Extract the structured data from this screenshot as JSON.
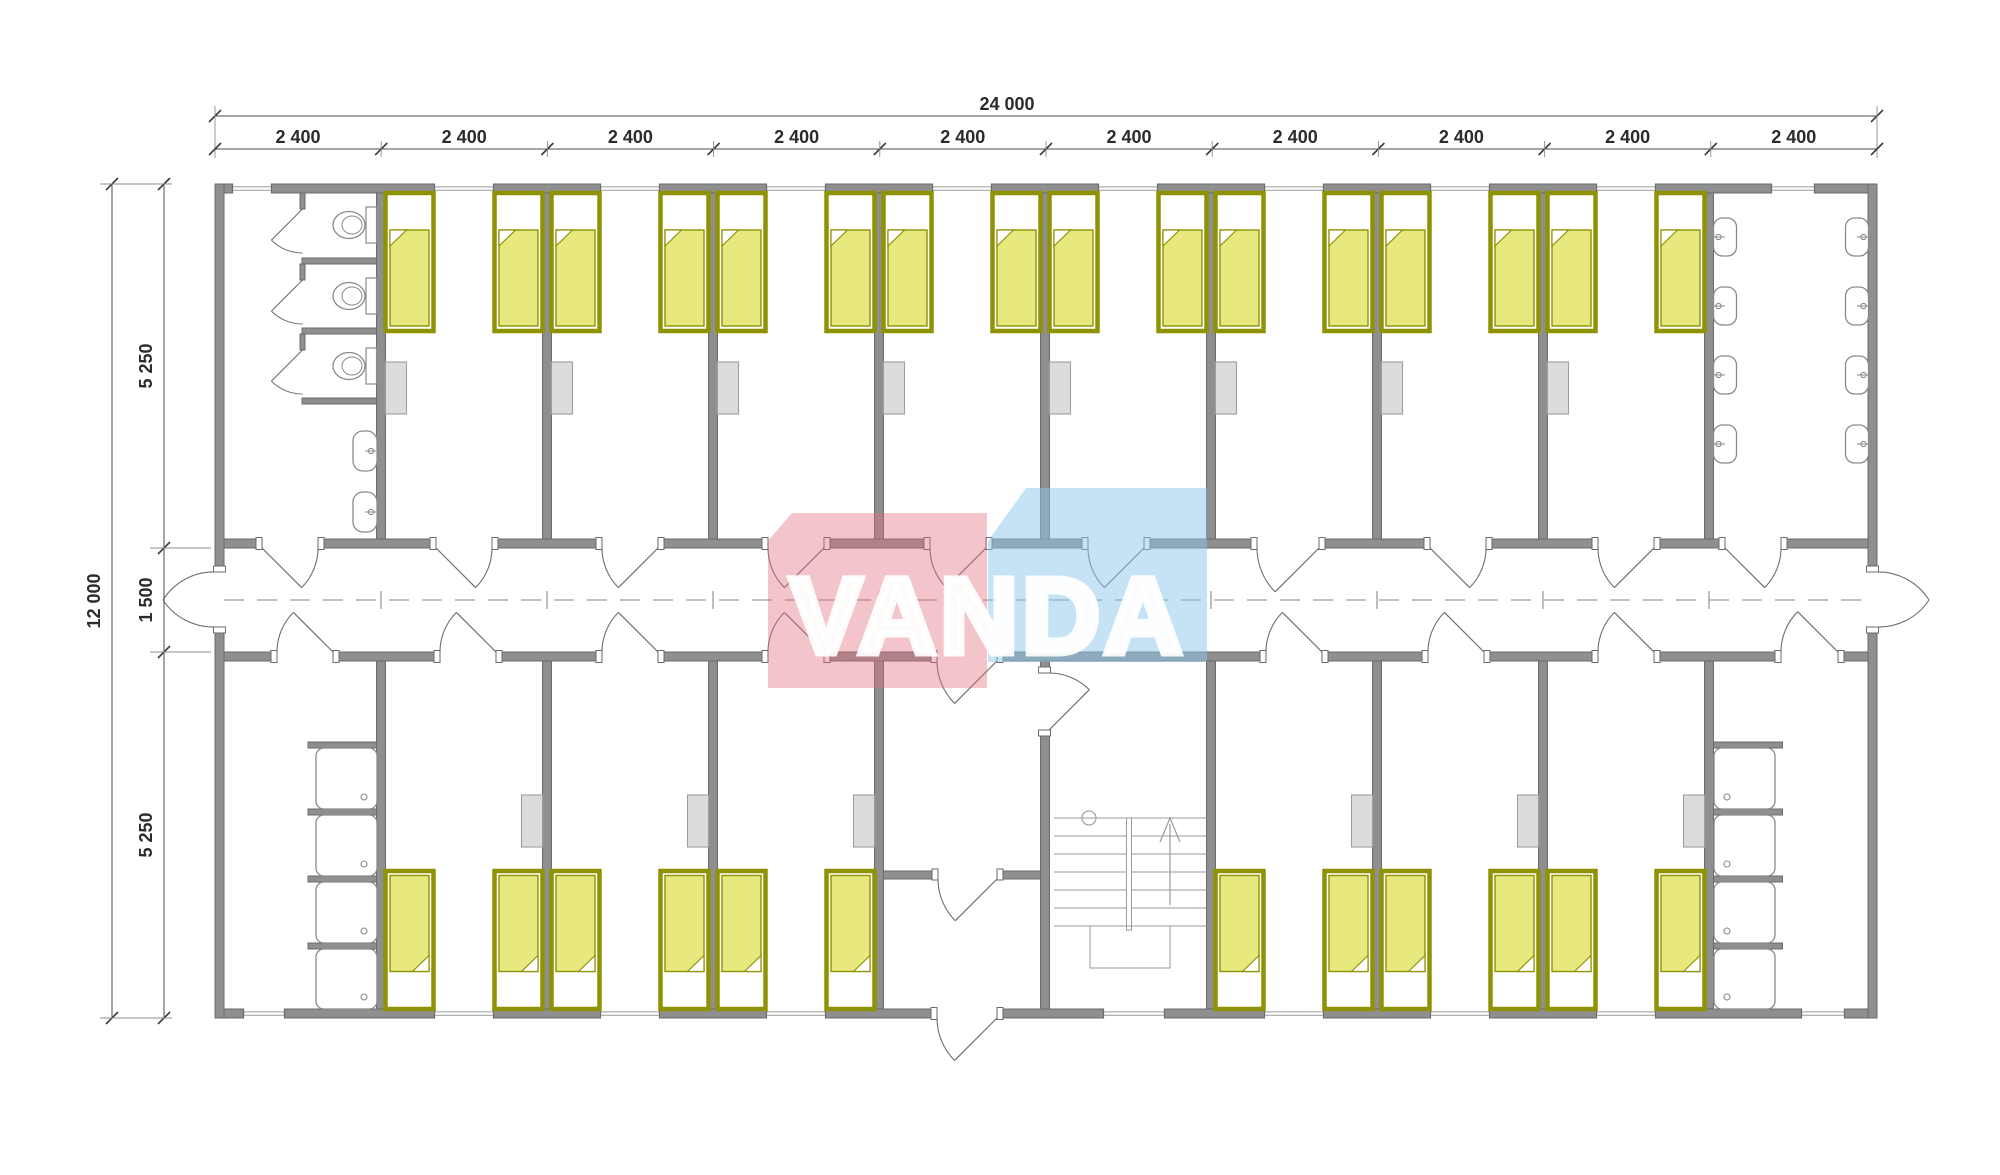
{
  "page": {
    "width": 2000,
    "height": 1175,
    "background": "#ffffff"
  },
  "watermark": {
    "text": "VANDA",
    "pink": "rgba(226,107,119,0.40)",
    "blue": "rgba(140,199,236,0.50)",
    "text_color": "rgba(255,255,255,0.92)"
  },
  "dimensions": {
    "total_width_label": "24 000",
    "module_labels": [
      "2 400",
      "2 400",
      "2 400",
      "2 400",
      "2 400",
      "2 400",
      "2 400",
      "2 400",
      "2 400",
      "2 400"
    ],
    "total_height_label": "12 000",
    "height_segment_labels": [
      "5 250",
      "1 500",
      "5 250"
    ]
  },
  "plan_summary": {
    "building_mm": {
      "width": 24000,
      "depth": 12000
    },
    "module_width_mm": 2400,
    "modules": 10,
    "zones_mm": {
      "north_band": 5250,
      "corridor": 1500,
      "south_band": 5250
    },
    "bedrooms": 14,
    "beds": 28,
    "toilets": 3,
    "wash_basins": 10,
    "showers": 8,
    "features": [
      "central corridor",
      "staircase",
      "entrance vestibule",
      "end exit doors"
    ]
  },
  "colors": {
    "wall": "#8f8f8f",
    "wall_edge": "#6b6b6b",
    "bed_frame": "#8f9303",
    "bed_blanket": "#e7e87e",
    "pillow": "#ffffff",
    "cabinet": "#dcdcdc",
    "cabinet_edge": "#9f9f9f",
    "fixture": "#8a8a8a",
    "swing": "#6e6e6e",
    "stair": "#9a9a9a",
    "axis": "#9a9a9a",
    "dim": "#4d4d4d",
    "dim_light": "#8d8d8d",
    "dim_text": "#2b2b2b"
  }
}
